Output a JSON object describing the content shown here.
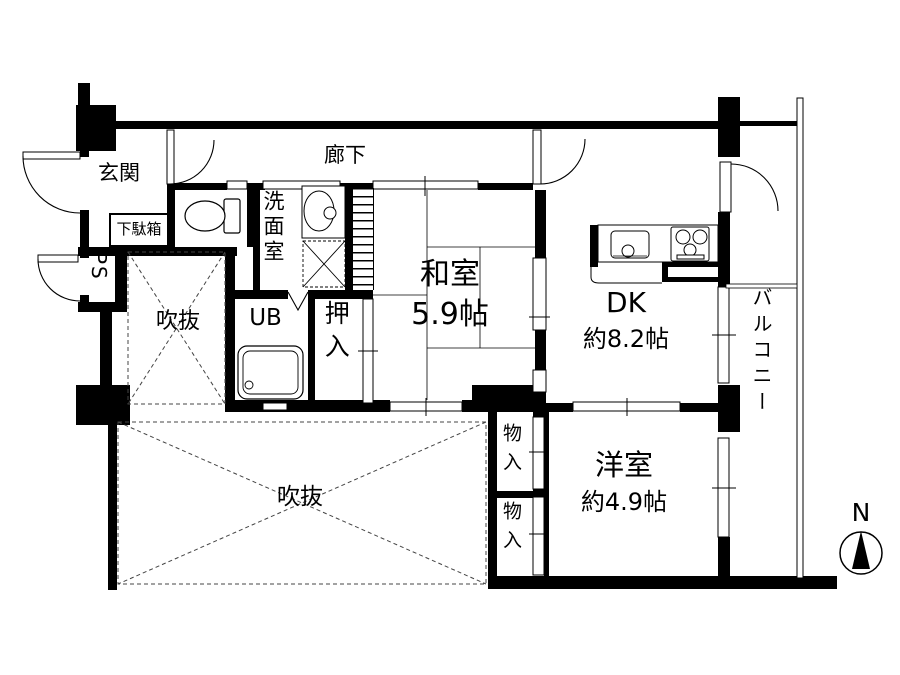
{
  "colors": {
    "wall": "#000000",
    "background": "#ffffff",
    "thin_line": "#000000",
    "dashed_line": "#444444"
  },
  "rooms": {
    "genkan": {
      "label": "玄関"
    },
    "getabako": {
      "label": "下駄箱"
    },
    "ps": {
      "label": "PS"
    },
    "rouka": {
      "label": "廊下"
    },
    "senmen": {
      "label": "洗面室"
    },
    "ub": {
      "label": "UB"
    },
    "oshiire": {
      "label": "押入"
    },
    "washitsu": {
      "label": "和室",
      "size": "5.9帖"
    },
    "dk": {
      "label": "DK",
      "size": "約8.2帖"
    },
    "yoshitsu": {
      "label": "洋室",
      "size": "約4.9帖"
    },
    "balcony": {
      "label": "バルコニー"
    },
    "fukinuke_upper": {
      "label": "吹抜"
    },
    "fukinuke_lower": {
      "label": "吹抜"
    },
    "mononyu_upper": {
      "label": "物入"
    },
    "mononyu_lower": {
      "label": "物入"
    }
  },
  "compass": {
    "label": "N"
  },
  "fixtures": [
    "toilet",
    "wash-basin",
    "washing-machine-space",
    "bathtub",
    "kitchen-sink",
    "gas-stove",
    "entry-door",
    "balcony-door",
    "folding-door"
  ]
}
